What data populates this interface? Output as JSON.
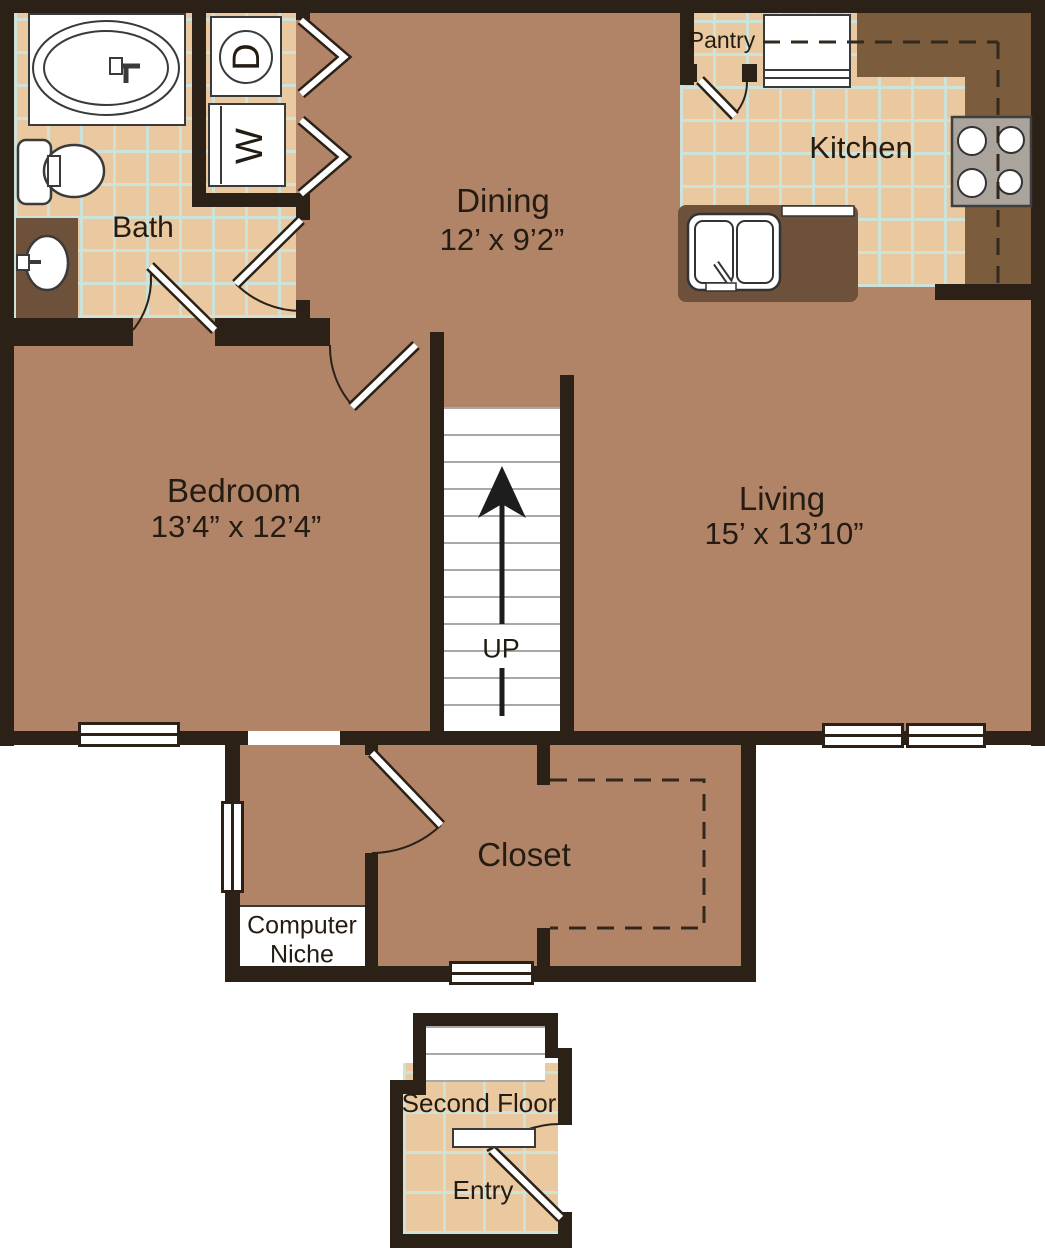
{
  "title": "Apartment floor plan",
  "colors": {
    "floor": "#b18468",
    "tile": "#eac9a1",
    "grout": "#cde3da",
    "wall": "#2b2117",
    "counter": "#7b5d3e",
    "counter2": "#6e513a",
    "stove": "#aba49d",
    "ink": "#241c12"
  },
  "rooms": {
    "bath": {
      "label": "Bath"
    },
    "dining": {
      "label": "Dining",
      "dims": "12’ x 9’2”"
    },
    "kitchen": {
      "label": "Kitchen"
    },
    "pantry": {
      "label": "Pantry"
    },
    "bedroom": {
      "label": "Bedroom",
      "dims": "13’4” x 12’4”"
    },
    "living": {
      "label": "Living",
      "dims": "15’ x 13’10”"
    },
    "closet": {
      "label": "Closet"
    },
    "computer_niche": {
      "label": "Computer Niche"
    },
    "stairs": {
      "label": "UP"
    },
    "entry": {
      "floor_label": "Second Floor",
      "label": "Entry"
    }
  },
  "fixtures": {
    "washer": {
      "label": "W"
    },
    "dryer": {
      "label": "D"
    },
    "icons": [
      "bathtub-icon",
      "toilet-icon",
      "vanity-sink-icon",
      "washer-icon",
      "dryer-icon",
      "refrigerator-icon",
      "stove-icon",
      "kitchen-sink-icon",
      "dishwasher-icon",
      "stairs-up-arrow-icon",
      "bifold-door-icon",
      "door-swing-icon",
      "window-icon",
      "overhead-cabinet-dashed-icon",
      "closet-rod-dashed-icon"
    ]
  }
}
